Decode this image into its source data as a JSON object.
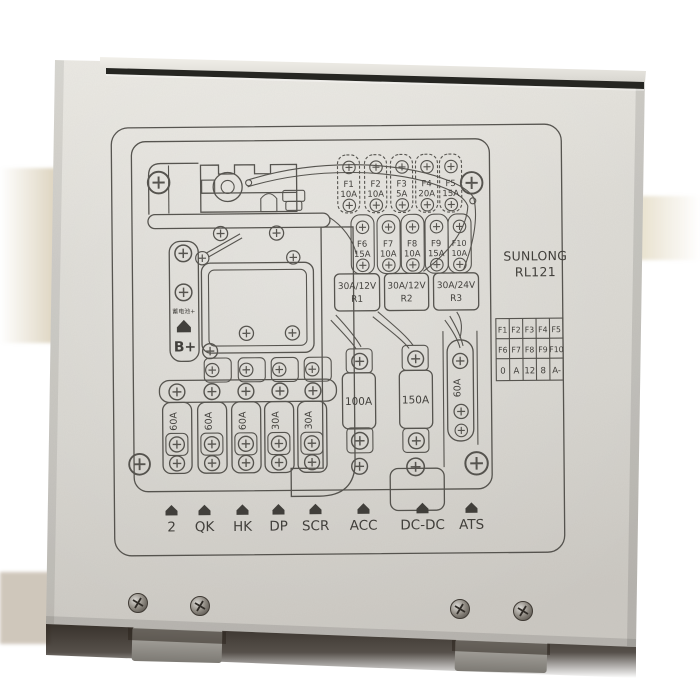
{
  "panel": {
    "brand": "SUNLONG",
    "model": "RL121",
    "colors": {
      "face": "#d9d7d1",
      "face_light": "#e9e7e1",
      "face_dark": "#ccc9c3",
      "print_line": "#4b4944",
      "lid_slot": "#262622",
      "bottom_shadow": "#2b241d",
      "bracket": "#97948e"
    }
  },
  "fuse_row1": [
    {
      "id": "F1",
      "amp": "10A"
    },
    {
      "id": "F2",
      "amp": "10A"
    },
    {
      "id": "F3",
      "amp": "5A"
    },
    {
      "id": "F4",
      "amp": "20A"
    },
    {
      "id": "F5",
      "amp": "15A"
    }
  ],
  "fuse_row2": [
    {
      "id": "F6",
      "amp": "15A"
    },
    {
      "id": "F7",
      "amp": "10A"
    },
    {
      "id": "F8",
      "amp": "10A"
    },
    {
      "id": "F9",
      "amp": "15A"
    },
    {
      "id": "F10",
      "amp": "10A"
    }
  ],
  "relays": [
    {
      "rating": "30A/12V",
      "id": "R1"
    },
    {
      "rating": "30A/12V",
      "id": "R2"
    },
    {
      "rating": "30A/24V",
      "id": "R3"
    }
  ],
  "main_fuses": {
    "fuse_100": "100A",
    "fuse_150": "150A",
    "fuse_60": "60A"
  },
  "bank_fuses": [
    "60A",
    "60A",
    "60A",
    "30A",
    "30A"
  ],
  "battery": {
    "cn_label": "蓄电池+",
    "terminal": "B+"
  },
  "terminals": [
    "2",
    "QK",
    "HK",
    "DP",
    "SCR",
    "ACC",
    "DC-DC",
    "ATS"
  ],
  "legend_table": {
    "rows": [
      [
        "F1",
        "F2",
        "F3",
        "F4",
        "F5"
      ],
      [
        "F6",
        "F7",
        "F8",
        "F9",
        "F10"
      ],
      [
        "0",
        "A",
        "12",
        "8",
        "A-"
      ]
    ]
  }
}
